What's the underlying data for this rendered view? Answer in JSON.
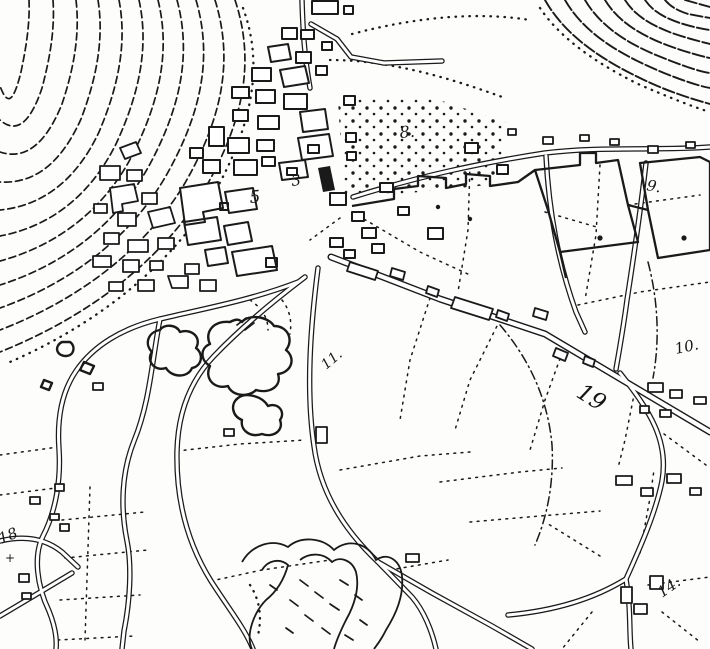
{
  "map": {
    "kind": "historic-cadastral-town-plan-scan",
    "ink_color": "#1a1a1a",
    "paper_color": "#fdfdfc",
    "labels": {
      "parcel_3": "3",
      "parcel_5": "5",
      "parcel_8": "8.",
      "parcel_9": "9.",
      "parcel_10": "10.",
      "parcel_11": "11.",
      "parcel_14": "14.",
      "parcel_18": "18",
      "parcel_19": "19",
      "cross_mark": "+"
    }
  }
}
